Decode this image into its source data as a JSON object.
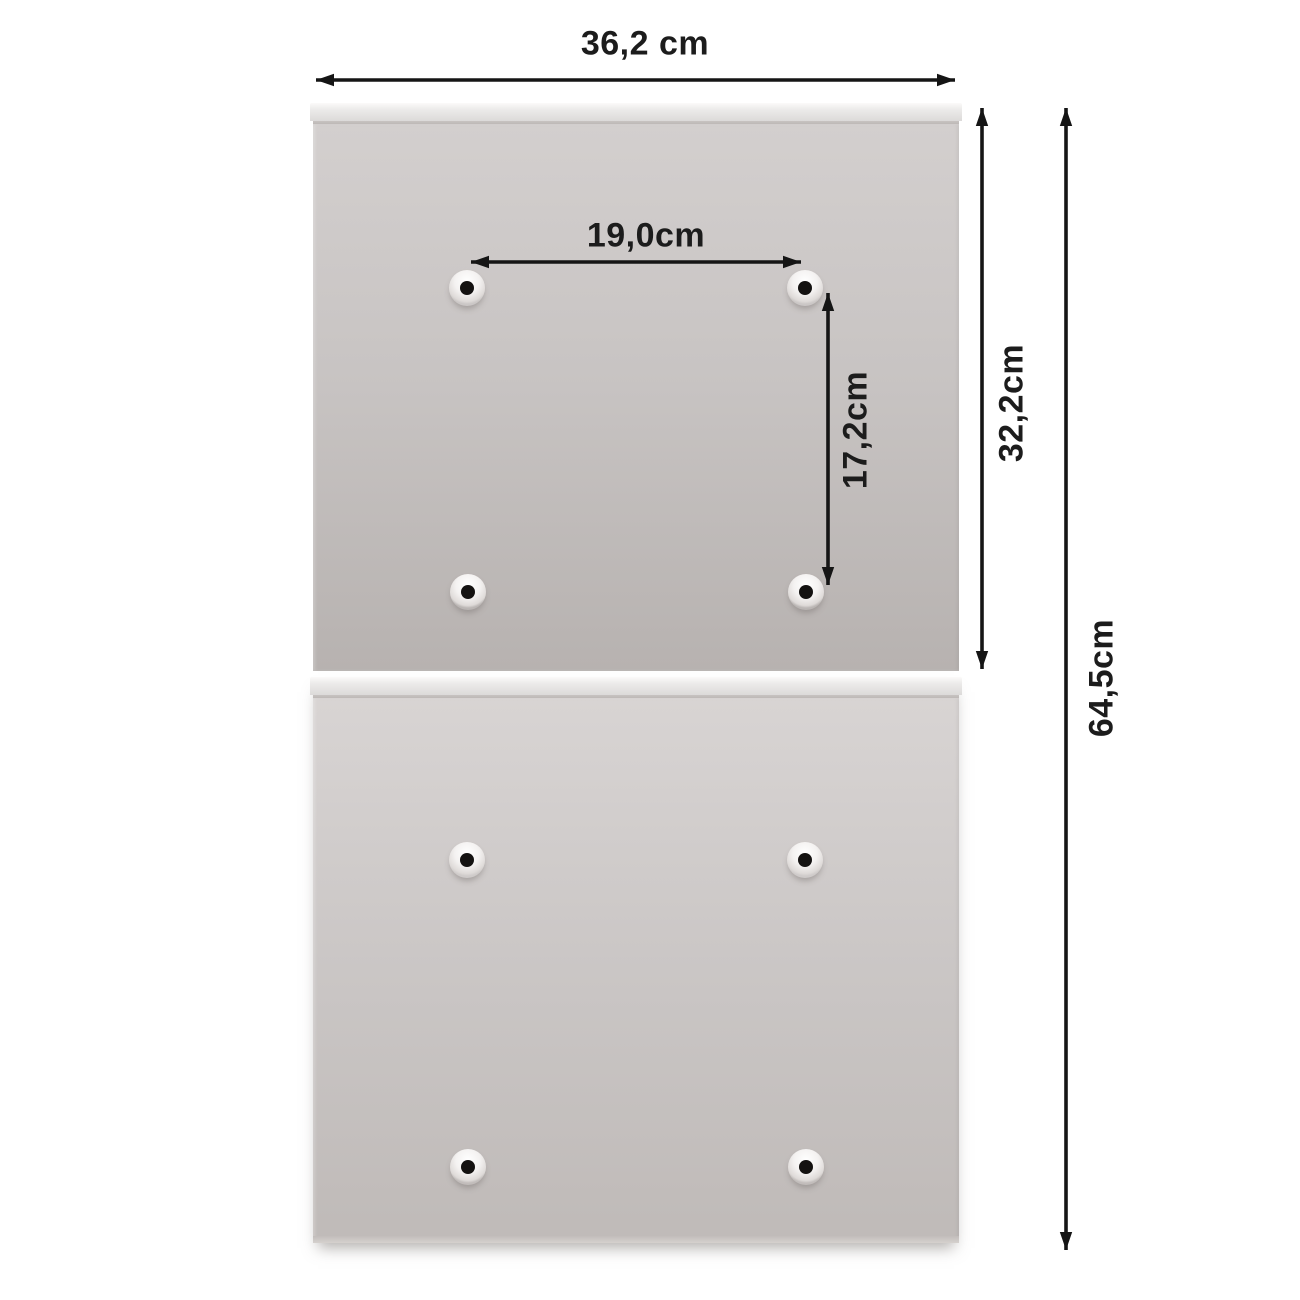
{
  "labels": {
    "width": "36,2 cm",
    "hole_spacing_horizontal": "19,0cm",
    "hole_spacing_vertical": "17,2cm",
    "upper_panel_height": "32,2cm",
    "total_height": "64,5cm"
  },
  "colors": {
    "background": "#ffffff",
    "dimension_line": "#151515",
    "label_text": "#1c1c1c",
    "panel_light": "#d8d4d3",
    "panel_dark": "#b7b2b0",
    "lip_highlight": "#fbfaf9",
    "hole_dot": "#141211"
  },
  "holes": [
    {
      "x": 467,
      "y": 288
    },
    {
      "x": 805,
      "y": 288
    },
    {
      "x": 468,
      "y": 592
    },
    {
      "x": 806,
      "y": 592
    },
    {
      "x": 467,
      "y": 860
    },
    {
      "x": 805,
      "y": 860
    },
    {
      "x": 468,
      "y": 1167
    },
    {
      "x": 806,
      "y": 1167
    }
  ]
}
